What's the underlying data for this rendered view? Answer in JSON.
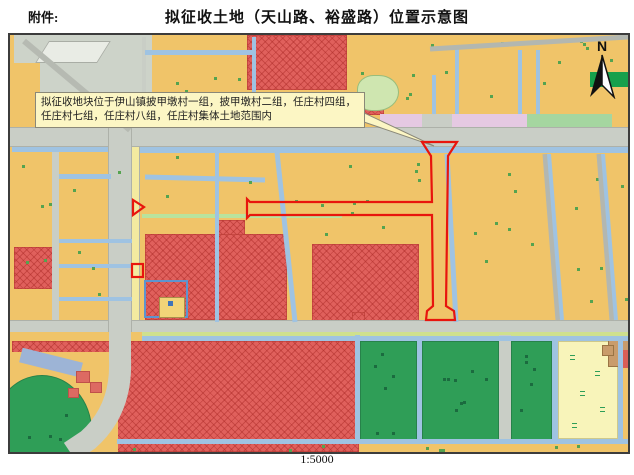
{
  "header": {
    "attachment_label": "附件:",
    "title": "拟征收土地（天山路、裕盛路）位置示意图"
  },
  "map": {
    "callout_text": "拟征收地块位于伊山镇披甲墩村一组，披甲墩村二组，任庄村四组，任庄村七组，任庄村八组，任庄村集体土地范围内",
    "north_label": "N",
    "scale_label": "1:5000"
  },
  "colors": {
    "orange": "#f0c469",
    "hatch": "#e0605c",
    "road": "#c9cec6",
    "canal": "#9fc3e2",
    "green": "#2f9e57",
    "pale-yellow": "#f8f4ba",
    "callout-bg": "#fcf6c4",
    "accent-red": "#e8150d",
    "gray-area": "#cdd3c9",
    "pink": "#e5c9e2",
    "lgreen": "#a5d6a0",
    "dgreen": "#17a04c"
  }
}
